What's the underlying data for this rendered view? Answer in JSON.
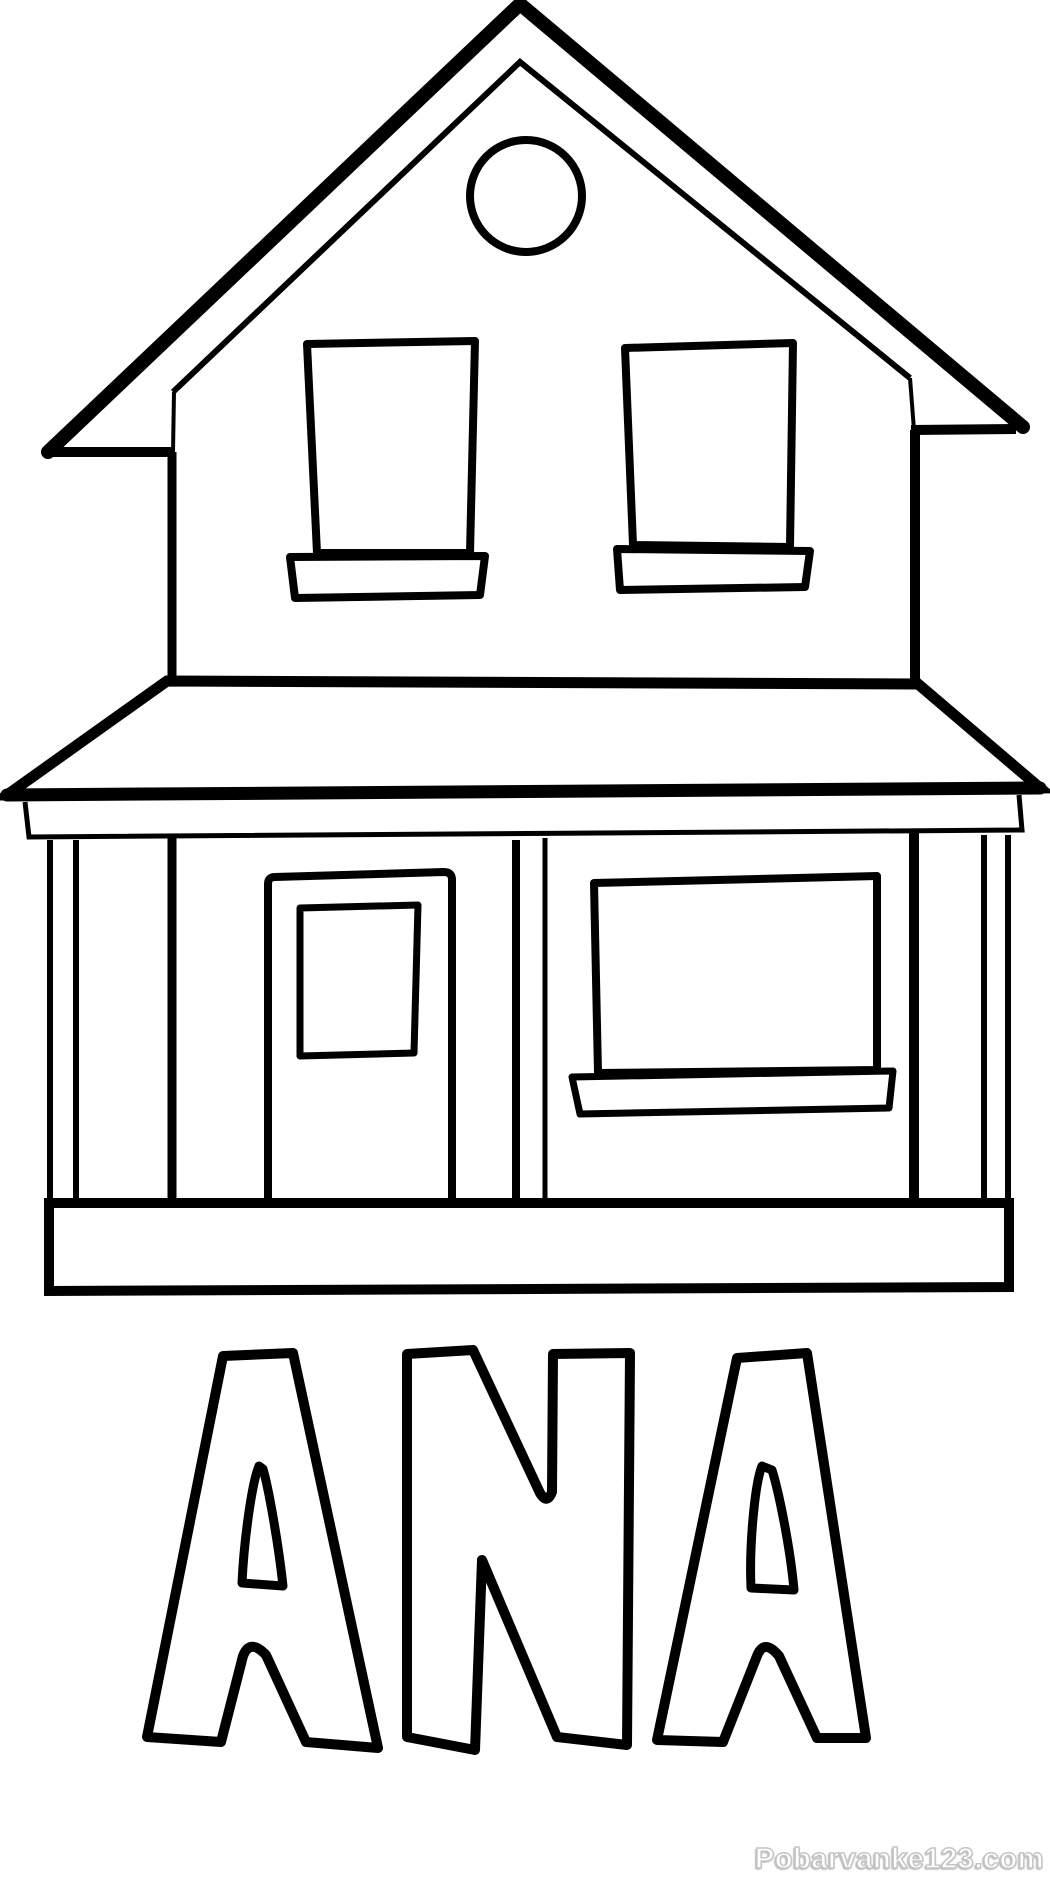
{
  "page": {
    "kind": "coloring-page",
    "background_color": "#ffffff",
    "line_color": "#000000",
    "fill_color": "#ffffff"
  },
  "illustration": {
    "subject": "two-story house with porch awning, round gable window, two upper windows, door and shop window",
    "aria_label": "Black and white coloring page drawing of a house"
  },
  "name_text": "ANA",
  "watermark": {
    "text": "Pobarvanke123.com",
    "text_color": "#ffffff",
    "outline_color": "#c4c4c4",
    "shadow_color": "#bfbfbf"
  }
}
